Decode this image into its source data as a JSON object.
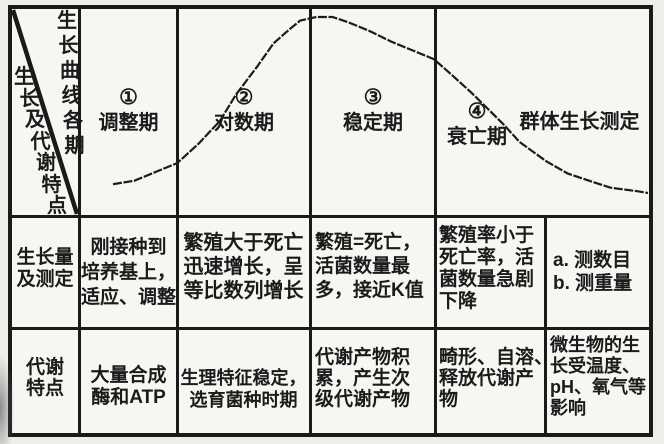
{
  "table": {
    "corner": {
      "top_right_text": "生长曲线各期",
      "bottom_left_text": "生长及代谢特点"
    },
    "phases_row": {
      "phase1_num": "①",
      "phase1_name": "调整期",
      "phase2_num": "②",
      "phase2_name": "对数期",
      "phase3_num": "③",
      "phase3_name": "稳定期",
      "phase4_num": "④",
      "phase4_name": "衰亡期",
      "group_label": "群体生长测定"
    },
    "rows": [
      {
        "header": [
          "生长量",
          "及测定"
        ],
        "cells": [
          [
            "刚接种到",
            "培养基上，",
            "适应、调整"
          ],
          [
            "繁殖大于死亡",
            "迅速增长，呈",
            "等比数列增长"
          ],
          [
            "繁殖=死亡，",
            "活菌数量最",
            "多，接近K值"
          ],
          [
            "繁殖率小于",
            "死亡率，活",
            "菌数量急剧",
            "下降"
          ],
          [
            "a.  测数目",
            "b.  测重量"
          ]
        ]
      },
      {
        "header": [
          "代谢",
          "特点"
        ],
        "cells": [
          [
            "大量合成",
            "酶和ATP"
          ],
          [
            "生理特征稳定，",
            "选育菌种时期"
          ],
          [
            "代谢产物积",
            "累，产生次",
            "级代谢产物"
          ],
          [
            "畸形、自溶、",
            "释放代谢产",
            "物"
          ],
          [
            "微生物的生",
            "长受温度、",
            "pH、氧气等",
            "影响"
          ]
        ]
      }
    ]
  },
  "chart_data": {
    "type": "line",
    "title": "细菌群体生长曲线（生长曲线各期）",
    "xlabel": "时间（相对单位 0-100）",
    "ylabel": "活菌数量（相对值 0-100）",
    "legend": "none",
    "grid": false,
    "phases": [
      {
        "num": "①",
        "name": "调整期",
        "t_range": [
          0,
          12
        ]
      },
      {
        "num": "②",
        "name": "对数期",
        "t_range": [
          12,
          37
        ]
      },
      {
        "num": "③",
        "name": "稳定期",
        "t_range": [
          37,
          60
        ]
      },
      {
        "num": "④",
        "name": "衰亡期",
        "t_range": [
          60,
          100
        ]
      }
    ],
    "points": [
      [
        0,
        5
      ],
      [
        4,
        7
      ],
      [
        8,
        12
      ],
      [
        12,
        17
      ],
      [
        16,
        28
      ],
      [
        20,
        41
      ],
      [
        23,
        56
      ],
      [
        27,
        72
      ],
      [
        30,
        85
      ],
      [
        33,
        93
      ],
      [
        35,
        98
      ],
      [
        38,
        100
      ],
      [
        41,
        100
      ],
      [
        44,
        97
      ],
      [
        48,
        92
      ],
      [
        52,
        86
      ],
      [
        56,
        81
      ],
      [
        60,
        76
      ],
      [
        63,
        68
      ],
      [
        67,
        57
      ],
      [
        70,
        48
      ],
      [
        73,
        39
      ],
      [
        76,
        29
      ],
      [
        81,
        18
      ],
      [
        85,
        11
      ],
      [
        89,
        7
      ],
      [
        93,
        3
      ],
      [
        98,
        1
      ],
      [
        100,
        0
      ]
    ]
  }
}
